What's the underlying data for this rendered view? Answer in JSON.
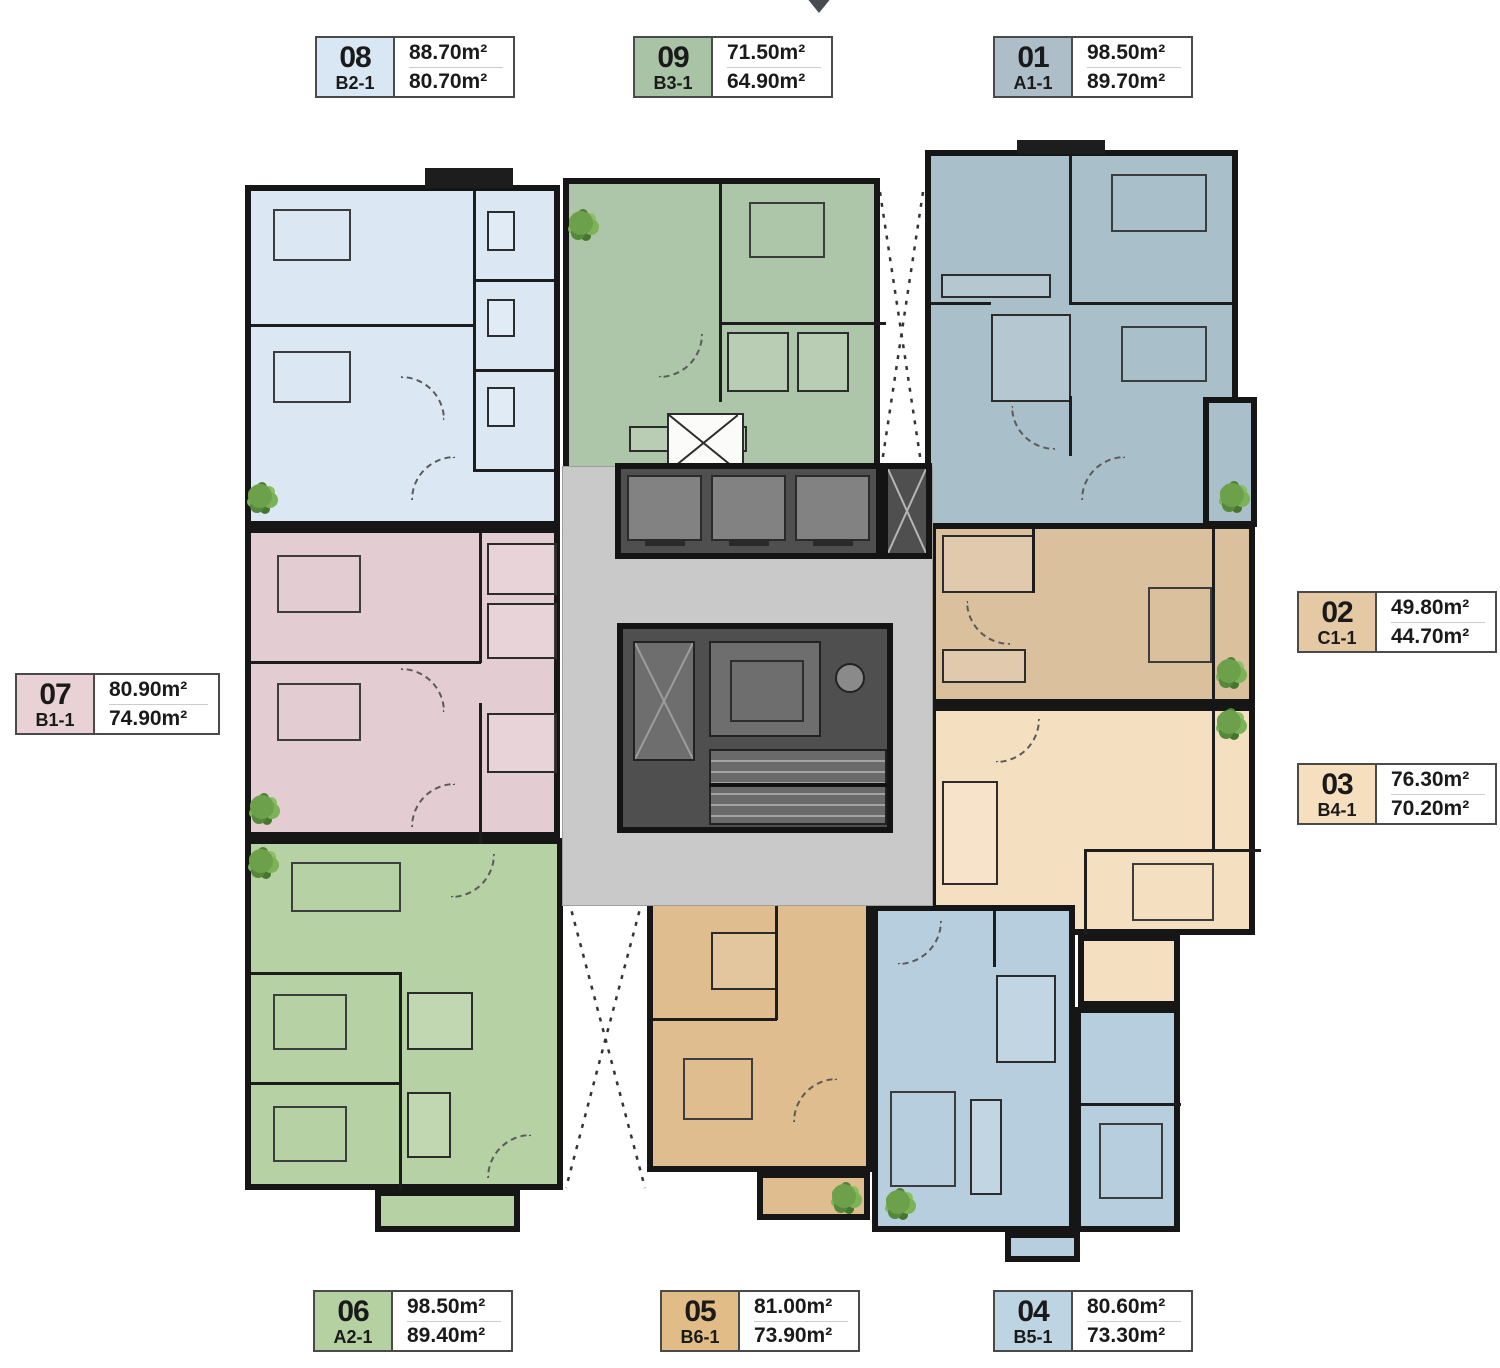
{
  "plan": {
    "wall_color": "#161616",
    "corridor_color": "#c9c9c9",
    "core_block_color": "#4f4f4f",
    "tree_color": "#6da04b"
  },
  "units": [
    {
      "number": "01",
      "type": "A1-1",
      "gross_area": "98.50m²",
      "net_area": "89.70m²",
      "badge_color": "#adbec8",
      "plan_color": "#a9bfca"
    },
    {
      "number": "02",
      "type": "C1-1",
      "gross_area": "49.80m²",
      "net_area": "44.70m²",
      "badge_color": "#e4c9a4",
      "plan_color": "#dbc09e"
    },
    {
      "number": "03",
      "type": "B4-1",
      "gross_area": "76.30m²",
      "net_area": "70.20m²",
      "badge_color": "#f6dfbe",
      "plan_color": "#f5dfc1"
    },
    {
      "number": "04",
      "type": "B5-1",
      "gross_area": "80.60m²",
      "net_area": "73.30m²",
      "badge_color": "#bdd4e2",
      "plan_color": "#b7cedf"
    },
    {
      "number": "05",
      "type": "B6-1",
      "gross_area": "81.00m²",
      "net_area": "73.90m²",
      "badge_color": "#e2bc87",
      "plan_color": "#e0bd8e"
    },
    {
      "number": "06",
      "type": "A2-1",
      "gross_area": "98.50m²",
      "net_area": "89.40m²",
      "badge_color": "#b5d1a2",
      "plan_color": "#b6d1a4"
    },
    {
      "number": "07",
      "type": "B1-1",
      "gross_area": "80.90m²",
      "net_area": "74.90m²",
      "badge_color": "#e8d2d5",
      "plan_color": "#e4cdd2"
    },
    {
      "number": "08",
      "type": "B2-1",
      "gross_area": "88.70m²",
      "net_area": "80.70m²",
      "badge_color": "#d8e7f3",
      "plan_color": "#dbe8f4"
    },
    {
      "number": "09",
      "type": "B3-1",
      "gross_area": "71.50m²",
      "net_area": "64.90m²",
      "badge_color": "#a9c3a6",
      "plan_color": "#adc5a9"
    }
  ]
}
